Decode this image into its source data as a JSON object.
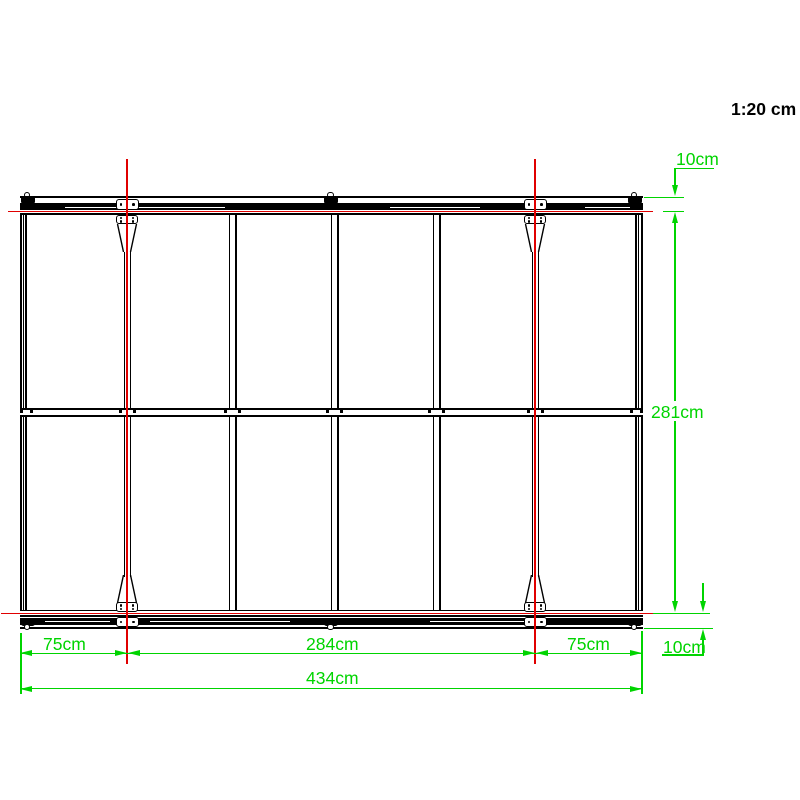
{
  "scale_label": "1:20 cm",
  "dimensions": {
    "top_rail_depth": "10cm",
    "frame_height": "281cm",
    "bottom_rail_depth": "10cm",
    "left_bay": "75cm",
    "center_bay": "284cm",
    "right_bay": "75cm",
    "total_width": "434cm"
  },
  "colors": {
    "dimension_green": "#00d400",
    "centerline_red": "#e00000",
    "frame_black": "#000000"
  }
}
